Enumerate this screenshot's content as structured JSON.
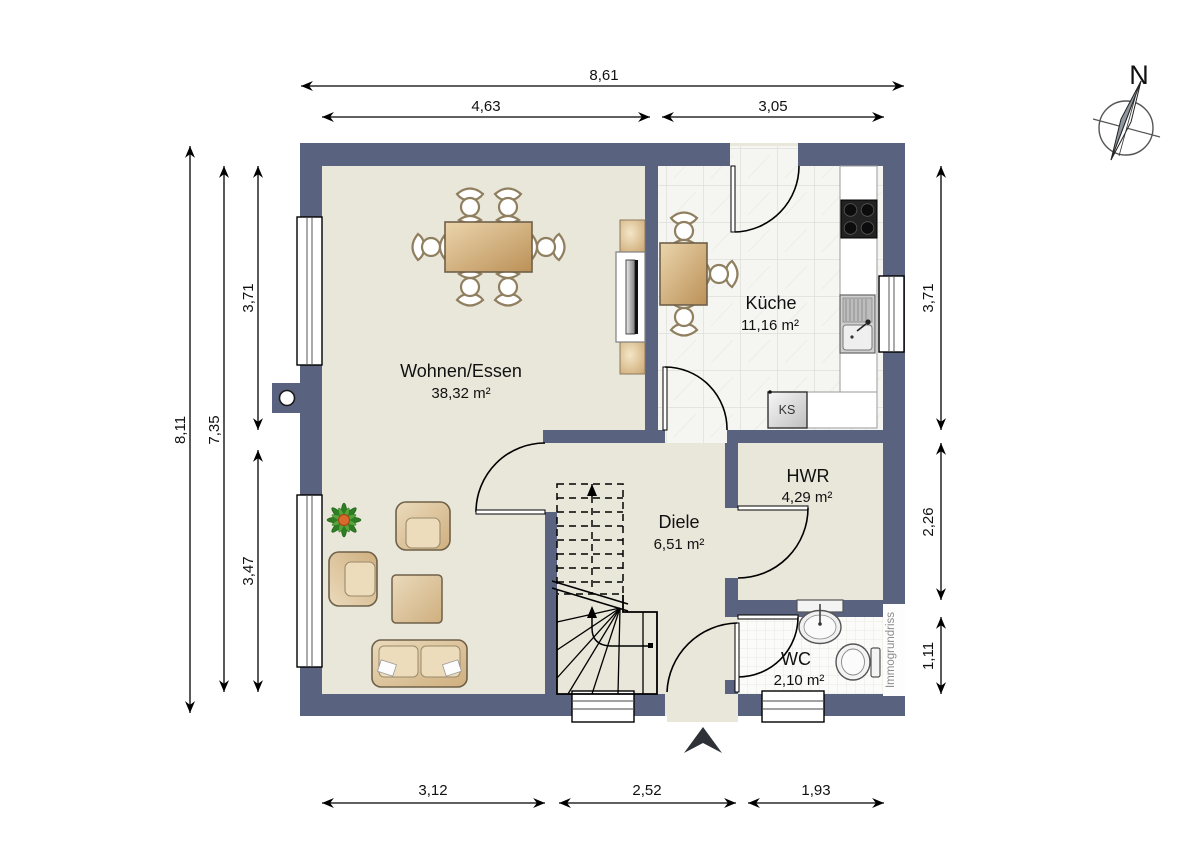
{
  "palette": {
    "wall": "#59627F",
    "floor": "#E9E6DA",
    "tile": "#F5F5F2",
    "grout": "#DBDBD5",
    "wood_dark": "#C59A63",
    "wood_light": "#EBD5AC",
    "watermark_text": "#8C8C8C"
  },
  "rooms": {
    "wohnen_essen": {
      "name": "Wohnen/Essen",
      "area": "38,32 m²"
    },
    "kueche": {
      "name": "Küche",
      "area": "11,16 m²"
    },
    "diele": {
      "name": "Diele",
      "area": "6,51 m²"
    },
    "hwr": {
      "name": "HWR",
      "area": "4,29 m²"
    },
    "wc": {
      "name": "WC",
      "area": "2,10 m²"
    }
  },
  "fixtures": {
    "fridge_label": "KS"
  },
  "compass": {
    "north_label": "N"
  },
  "watermark": {
    "text": "Immogrundriss"
  },
  "dimensions": {
    "top": {
      "total": "8,61",
      "left": "4,63",
      "right": "3,05"
    },
    "left": {
      "total": "8,11",
      "inner": "7,35",
      "upper": "3,71",
      "lower": "3,47"
    },
    "right": {
      "upper": "3,71",
      "middle": "2,26",
      "lower": "1,11"
    },
    "bottom": {
      "left": "3,12",
      "middle": "2,52",
      "right": "1,93"
    }
  }
}
